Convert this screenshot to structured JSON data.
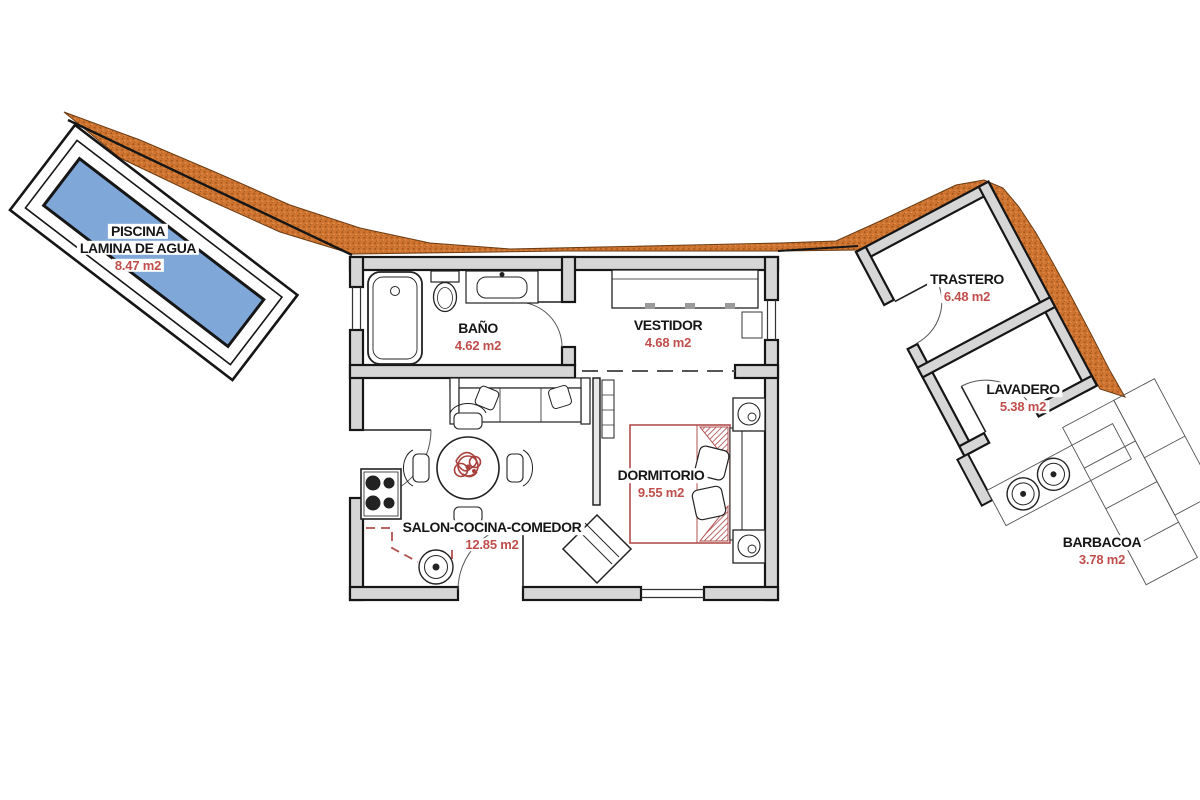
{
  "plan": {
    "title": "floor-plan",
    "rooms": {
      "piscina": {
        "name": "PISCINA",
        "name2": "LAMINA DE AGUA",
        "area": "8.47 m2"
      },
      "bano": {
        "name": "BAÑO",
        "area": "4.62 m2"
      },
      "vestidor": {
        "name": "VESTIDOR",
        "area": "4.68 m2"
      },
      "salon": {
        "name": "SALON-COCINA-COMEDOR",
        "area": "12.85 m2"
      },
      "dormitorio": {
        "name": "DORMITORIO",
        "area": "9.55 m2"
      },
      "trastero": {
        "name": "TRASTERO",
        "area": "6.48 m2"
      },
      "lavadero": {
        "name": "LAVADERO",
        "area": "5.38 m2"
      },
      "barbacoa": {
        "name": "BARBACOA",
        "area": "3.78 m2"
      }
    },
    "colors": {
      "water": "#7FA8D9",
      "terrain": "#CF7531",
      "terrain_dot": "#A5581C",
      "wall_fill": "#D6D6D6",
      "line": "#161616",
      "area_text": "#BF4F4C",
      "furniture_red": "#B0504F"
    }
  }
}
